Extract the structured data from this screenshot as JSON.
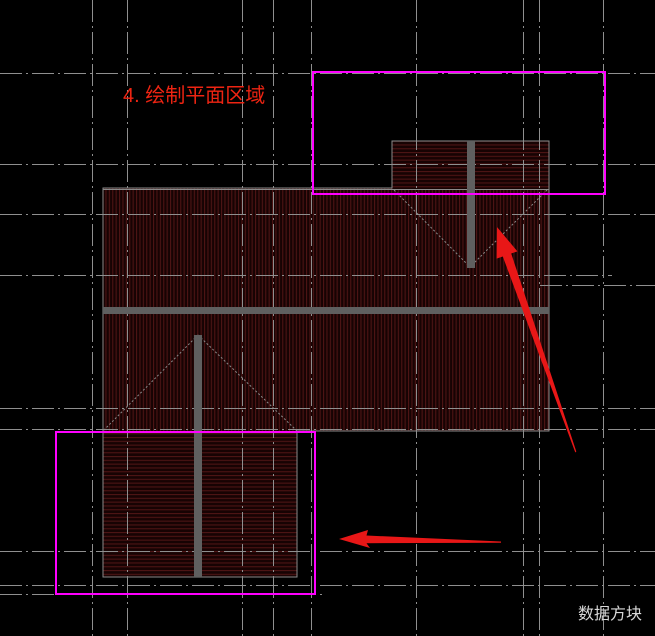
{
  "annotations": {
    "step_label": "4. 绘制平面区域",
    "watermark": "数据方块"
  },
  "colors": {
    "background": "#000000",
    "grid_line": "#8f8f8f",
    "selection_box": "#ff00ff",
    "arrow": "#e81717",
    "step_label_text": "#ee2412",
    "watermark_text": "#d9d9d9",
    "roof_outline": "#8a8a8a",
    "roof_hatch_line": "#4d1414",
    "roof_hatch_bg": "#170303",
    "ridge_bar": "#5f5f5f"
  }
}
